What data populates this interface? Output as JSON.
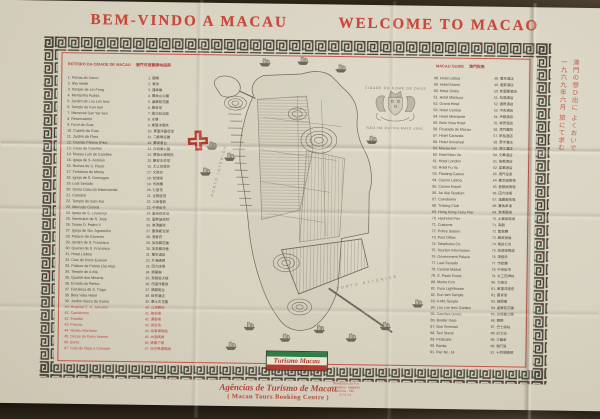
{
  "poster": {
    "title_pt": "BEM-VINDO A MACAU",
    "title_en": "WELCOME TO MACAO"
  },
  "left_index": {
    "title_pt": "ROTEIRO DA CIDADE DE MACAU",
    "title_zh": "澳門市遊覽勝地指南",
    "items": [
      {
        "n": "1",
        "name": "Portas do Cerco",
        "zh": "關閘"
      },
      {
        "n": "2",
        "name": "Ilha Verde",
        "zh": "青洲"
      },
      {
        "n": "3",
        "name": "Templo de Lin Fong",
        "zh": "蓮峰廟"
      },
      {
        "n": "4",
        "name": "Montanha Russa",
        "zh": "螺絲山公園"
      },
      {
        "n": "5",
        "name": "Jardim de Lou Lim Ieoc",
        "zh": "盧廉若花園"
      },
      {
        "n": "6",
        "name": "Templo de Kun Iam",
        "zh": "觀音堂"
      },
      {
        "n": "7",
        "name": "Memorial Sun Yat Sen",
        "zh": "國父紀念館"
      },
      {
        "n": "8",
        "name": "Reservatório",
        "zh": "水塘"
      },
      {
        "n": "9",
        "name": "Farol da Guia",
        "zh": "東望洋燈塔"
      },
      {
        "n": "10",
        "name": "Capela da Guia",
        "zh": "東望洋聖母堂"
      },
      {
        "n": "11",
        "name": "Jardim da Flora",
        "zh": "二龍喉花園"
      },
      {
        "n": "12",
        "name": "Grande Prémio (Pits)",
        "zh": "賽車看台"
      },
      {
        "n": "13",
        "name": "Gruta de Camões",
        "zh": "白鴿巢公園"
      },
      {
        "n": "14",
        "name": "Museu Luís de Camões",
        "zh": "賈梅士博物院"
      },
      {
        "n": "15",
        "name": "Igreja de S. António",
        "zh": "聖安多尼堂"
      },
      {
        "n": "16",
        "name": "Ruínas de S. Paulo",
        "zh": "大三巴牌坊"
      },
      {
        "n": "17",
        "name": "Fortaleza do Monte",
        "zh": "大砲台"
      },
      {
        "n": "18",
        "name": "Igreja de S. Domingos",
        "zh": "玫瑰堂"
      },
      {
        "n": "19",
        "name": "Leal Senado",
        "zh": "市政廳"
      },
      {
        "n": "20",
        "name": "Santa Casa da Misericórdia",
        "zh": "仁慈堂"
      },
      {
        "n": "21",
        "name": "Catedral",
        "zh": "主教座堂"
      },
      {
        "n": "22",
        "name": "Templo de Sam Kai",
        "zh": "三街會館"
      },
      {
        "n": "23",
        "name": "Mercado Central",
        "zh": "中央街市"
      },
      {
        "n": "24",
        "name": "Igreja de S. Lourenço",
        "zh": "聖老楞佐堂"
      },
      {
        "n": "25",
        "name": "Seminário de S. José",
        "zh": "聖若瑟修院"
      },
      {
        "n": "26",
        "name": "Teatro D. Pedro V",
        "zh": "崗頂劇院"
      },
      {
        "n": "27",
        "name": "Igreja de Sto. Agostinho",
        "zh": "聖奧斯定堂"
      },
      {
        "n": "28",
        "name": "Palácio do Governo",
        "zh": "澳督府"
      },
      {
        "n": "29",
        "name": "Jardim de S. Francisco",
        "zh": "加思欄花園"
      },
      {
        "n": "30",
        "name": "Quartel de S. Francisco",
        "zh": "加思欄兵營"
      },
      {
        "n": "31",
        "name": "Hotel Lisboa",
        "zh": "葡京酒店"
      },
      {
        "n": "32",
        "name": "Cais do Porto Exterior",
        "zh": "外港碼頭"
      },
      {
        "n": "33",
        "name": "Palácio de Pelota (Jai Alai)",
        "zh": "回力球場"
      },
      {
        "n": "34",
        "name": "Templo de A-Má",
        "zh": "媽閣廟"
      },
      {
        "n": "35",
        "name": "Quartel dos Mouros",
        "zh": "港務局大樓"
      },
      {
        "n": "36",
        "name": "Ermida da Penha",
        "zh": "西望洋聖堂"
      },
      {
        "n": "37",
        "name": "Fortaleza de S. Tiago",
        "zh": "媽閣砲台"
      },
      {
        "n": "38",
        "name": "Bela Vista Hotel",
        "zh": "峰景酒店"
      },
      {
        "n": "39",
        "name": "Jardim Vasco da Gama",
        "zh": "華士古花園"
      },
      {
        "n": "40",
        "name": "Hospital C. S. Januário",
        "zh": "山頂醫院",
        "red": true
      },
      {
        "n": "41",
        "name": "Canídromo",
        "zh": "跑狗場",
        "red": true
      },
      {
        "n": "42",
        "name": "Estádio",
        "zh": "運動場",
        "red": true
      },
      {
        "n": "43",
        "name": "Piscina",
        "zh": "游泳池",
        "red": true
      },
      {
        "n": "44",
        "name": "Museu Marítimo",
        "zh": "海事博物館",
        "red": true
      },
      {
        "n": "45",
        "name": "Docas do Porto Interior",
        "zh": "內港碼頭",
        "red": true
      },
      {
        "n": "46",
        "name": "Barra",
        "zh": "媽閣下環",
        "red": true
      },
      {
        "n": "47",
        "name": "Cais da Taipa e Coloane",
        "zh": "氹仔路環碼頭",
        "red": true
      }
    ]
  },
  "right_index": {
    "title_en": "MACAU GUIDE",
    "title_zh": "澳門指南",
    "items": [
      {
        "n": "48",
        "name": "Hotel Lisboa",
        "zh": "葡京酒店"
      },
      {
        "n": "49",
        "name": "Hotel Estoril",
        "zh": "愛都酒店"
      },
      {
        "n": "50",
        "name": "Hotel Sintra",
        "zh": "新麗華酒店"
      },
      {
        "n": "51",
        "name": "Hotel Matsuya",
        "zh": "松屋酒店"
      },
      {
        "n": "52",
        "name": "Grand Hotel",
        "zh": "國際酒店"
      },
      {
        "n": "53",
        "name": "Hotel Central",
        "zh": "中央酒店"
      },
      {
        "n": "54",
        "name": "Hotel Metropole",
        "zh": "京都酒店"
      },
      {
        "n": "55",
        "name": "Bela Vista Hotel",
        "zh": "峰景酒店"
      },
      {
        "n": "56",
        "name": "Pousada de Macau",
        "zh": "澳門賓館"
      },
      {
        "n": "57",
        "name": "Hotel Caravela",
        "zh": "帆船酒店"
      },
      {
        "n": "58",
        "name": "Hotel Universal",
        "zh": "寰宇酒店"
      },
      {
        "n": "59",
        "name": "Macau Inn",
        "zh": "濠江酒店"
      },
      {
        "n": "60",
        "name": "Hotel Man Va",
        "zh": "文華酒店"
      },
      {
        "n": "61",
        "name": "Hotel London",
        "zh": "倫敦酒店"
      },
      {
        "n": "62",
        "name": "Hotel Fu Va",
        "zh": "富華酒店"
      },
      {
        "n": "63",
        "name": "Floating Casino",
        "zh": "澳門皇宮"
      },
      {
        "n": "64",
        "name": "Casino Lisboa",
        "zh": "葡京娛樂場"
      },
      {
        "n": "65",
        "name": "Casino Estoril",
        "zh": "愛都娛樂場"
      },
      {
        "n": "66",
        "name": "Jai Alai Stadium",
        "zh": "回力球場"
      },
      {
        "n": "67",
        "name": "Canidrome",
        "zh": "逸園跑狗場"
      },
      {
        "n": "68",
        "name": "Trotting Club",
        "zh": "賽馬車場"
      },
      {
        "n": "69",
        "name": "Hong Kong Ferry Pier",
        "zh": "港澳碼頭"
      },
      {
        "n": "70",
        "name": "Hydrofoil Pier",
        "zh": "水翼船碼頭"
      },
      {
        "n": "71",
        "name": "Customs",
        "zh": "海關"
      },
      {
        "n": "72",
        "name": "Police Station",
        "zh": "警察廳"
      },
      {
        "n": "73",
        "name": "Post Office",
        "zh": "郵政總局"
      },
      {
        "n": "74",
        "name": "Telephone Co.",
        "zh": "電話公司"
      },
      {
        "n": "75",
        "name": "Tourism Information",
        "zh": "旅遊詢問處"
      },
      {
        "n": "76",
        "name": "Government Palace",
        "zh": "澳督府"
      },
      {
        "n": "77",
        "name": "Leal Senado",
        "zh": "市政廳"
      },
      {
        "n": "78",
        "name": "Central Market",
        "zh": "中央街市"
      },
      {
        "n": "79",
        "name": "S. Paulo Ruins",
        "zh": "大三巴牌坊"
      },
      {
        "n": "80",
        "name": "Monte Fort",
        "zh": "大砲台"
      },
      {
        "n": "81",
        "name": "Guia Lighthouse",
        "zh": "東望洋燈塔"
      },
      {
        "n": "82",
        "name": "Kun Iam Temple",
        "zh": "觀音堂"
      },
      {
        "n": "83",
        "name": "A-Má Temple",
        "zh": "媽閣廟"
      },
      {
        "n": "84",
        "name": "Lou Lim Ieoc Garden",
        "zh": "盧廉若花園"
      },
      {
        "n": "85",
        "name": "Camões Grotto",
        "zh": "白鴿巢公園"
      },
      {
        "n": "86",
        "name": "Border Gate",
        "zh": "關閘"
      },
      {
        "n": "87",
        "name": "Bus Terminal",
        "zh": "巴士總站"
      },
      {
        "n": "88",
        "name": "Taxi Stand",
        "zh": "的士站"
      },
      {
        "n": "89",
        "name": "Pedicabs",
        "zh": "三輪車"
      },
      {
        "n": "90",
        "name": "Banks",
        "zh": "銀行區"
      },
      {
        "n": "91",
        "name": "Pier No. 14",
        "zh": "十四號碼頭"
      }
    ]
  },
  "map": {
    "city_label": "CIDADE DO NOME DE DEUS",
    "motto": "NÃO HÁ OUTRA MAIS LEAL",
    "label_inner_harbour": "PORTO INTERIOR",
    "label_outer_harbour": "PORTO EXTERIOR"
  },
  "logo": {
    "text": "Turismo Macau"
  },
  "footer": {
    "agency_pt": "Agências de Turismo de Macau",
    "agency_en": "( Macau Tours Booking Centre )",
    "contact_lines": [
      "TRAVESSA DO P. 9",
      "AVENIDA A. RIBEIRO",
      "MACAU · TEL.",
      "5 7 5 7 5"
    ]
  },
  "margin_note": {
    "lines": [
      "澳門の想ひ出に よくおいで",
      "一九六九年六月 旅にて求む"
    ]
  },
  "colors": {
    "title_red": "#c74a3c",
    "border_red": "#c4574a",
    "meander_dark": "#403e34",
    "paper": "#d7d1c0",
    "logo_green": "#2e7d46",
    "logo_red": "#b43a30",
    "map_ink": "#6e685c"
  }
}
